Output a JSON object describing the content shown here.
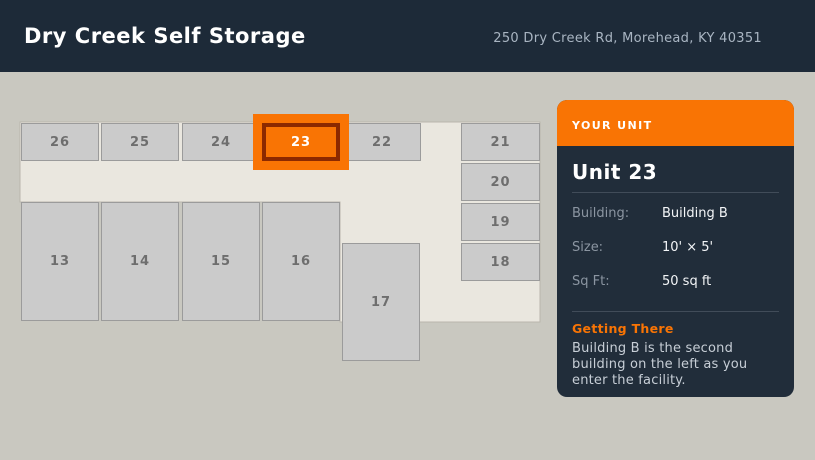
{
  "header": {
    "title": "Dry Creek Self Storage",
    "address": "250 Dry Creek Rd, Morehead, KY 40351"
  },
  "map": {
    "units": [
      {
        "label": "26",
        "highlighted": false
      },
      {
        "label": "25",
        "highlighted": false
      },
      {
        "label": "24",
        "highlighted": false
      },
      {
        "label": "23",
        "highlighted": true
      },
      {
        "label": "22",
        "highlighted": false
      },
      {
        "label": "21",
        "highlighted": false
      },
      {
        "label": "20",
        "highlighted": false
      },
      {
        "label": "19",
        "highlighted": false
      },
      {
        "label": "18",
        "highlighted": false
      },
      {
        "label": "13",
        "highlighted": false
      },
      {
        "label": "14",
        "highlighted": false
      },
      {
        "label": "15",
        "highlighted": false
      },
      {
        "label": "16",
        "highlighted": false
      },
      {
        "label": "17",
        "highlighted": false
      }
    ]
  },
  "panel": {
    "header_label": "YOUR UNIT",
    "title": "Unit 23",
    "details": [
      {
        "label": "Building:",
        "value": "Building B"
      },
      {
        "label": "Size:",
        "value": "10' × 5'"
      },
      {
        "label": "Sq Ft:",
        "value": "50 sq ft"
      }
    ],
    "directions_title": "Getting There",
    "directions_lines": [
      "Building B is the second",
      "building on the left as you",
      "enter the facility."
    ]
  },
  "colors": {
    "page-bg": "#c9c8c0",
    "header-bg": "#1d2a38",
    "header-title": "#ffffff",
    "header-address": "#a9b5c2",
    "building-fill": "#eae7df",
    "building-stroke": "#b9b6ad",
    "unit-fill": "#cbcbcb",
    "unit-border": "#9b9b9b",
    "unit-label": "#6e6e6e",
    "accent-orange": "#f97404",
    "highlight-border": "#8c2900",
    "panel-bg": "#212d3a",
    "panel-divider": "#414c59",
    "panel-label": "#8b95a1",
    "panel-value": "#f3f5f7",
    "panel-text": "#c7ced6"
  }
}
